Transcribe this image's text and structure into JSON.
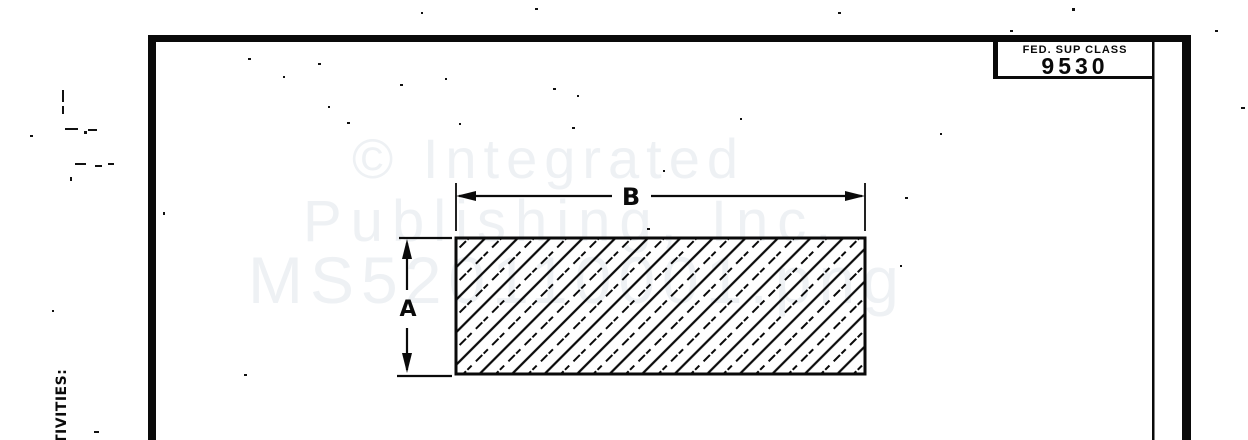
{
  "title_block": {
    "label": "FED. SUP CLASS",
    "value": "9530"
  },
  "watermark": {
    "line1": "© Integrated",
    "line2": "Publishing, Inc.",
    "line3": "MS520110001.png"
  },
  "figure": {
    "width_label": "B",
    "height_label": "A"
  },
  "margin_text": "TIVITIES:",
  "colors": {
    "ink": "#0a0a0a",
    "watermark": "#eef1f4",
    "paper": "#ffffff"
  },
  "specks": [
    [
      248,
      58,
      3,
      2
    ],
    [
      318,
      63,
      3,
      2
    ],
    [
      283,
      76,
      2,
      2
    ],
    [
      400,
      84,
      3,
      2
    ],
    [
      445,
      78,
      2,
      2
    ],
    [
      577,
      95,
      2,
      2
    ],
    [
      328,
      106,
      2,
      2
    ],
    [
      347,
      122,
      3,
      2
    ],
    [
      459,
      123,
      2,
      2
    ],
    [
      572,
      127,
      3,
      2
    ],
    [
      740,
      118,
      2,
      2
    ],
    [
      647,
      228,
      3,
      2
    ],
    [
      940,
      133,
      2,
      2
    ],
    [
      535,
      8,
      3,
      2
    ],
    [
      838,
      12,
      3,
      2
    ],
    [
      1072,
      8,
      3,
      3
    ],
    [
      421,
      12,
      2,
      2
    ],
    [
      1241,
      107,
      4,
      2
    ],
    [
      163,
      212,
      2,
      3
    ],
    [
      900,
      265,
      2,
      2
    ],
    [
      244,
      374,
      3,
      2
    ],
    [
      1215,
      30,
      3,
      2
    ],
    [
      30,
      135,
      3,
      2
    ],
    [
      94,
      431,
      5,
      2
    ],
    [
      52,
      310,
      2,
      2
    ],
    [
      62,
      90,
      2,
      12
    ],
    [
      62,
      106,
      2,
      8
    ],
    [
      65,
      128,
      13,
      2
    ],
    [
      88,
      129,
      9,
      2
    ],
    [
      84,
      131,
      3,
      3
    ],
    [
      75,
      163,
      11,
      2
    ],
    [
      95,
      165,
      7,
      2
    ],
    [
      108,
      163,
      6,
      2
    ],
    [
      70,
      177,
      2,
      4
    ],
    [
      553,
      88,
      3,
      2
    ],
    [
      663,
      170,
      2,
      2
    ],
    [
      905,
      197,
      3,
      2
    ],
    [
      1010,
      30,
      3,
      2
    ]
  ]
}
